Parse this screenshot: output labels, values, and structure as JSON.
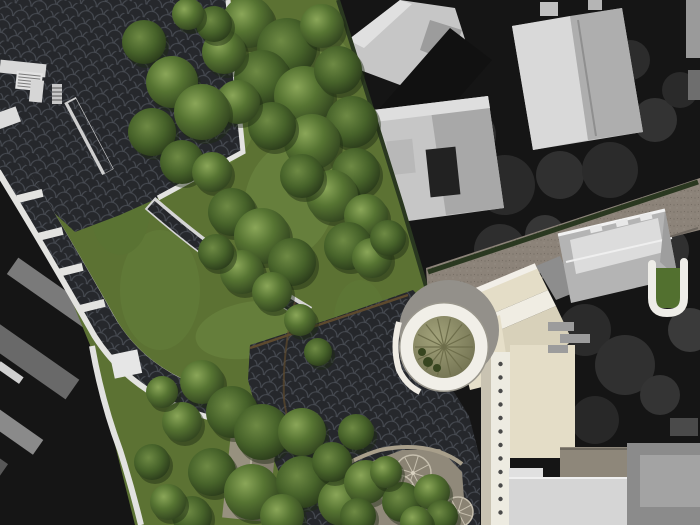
{
  "image": {
    "kind": "architectural-site-plan-render-over-aerial-photo",
    "width": 700,
    "height": 525
  },
  "palette": {
    "photo_dark": "#151515",
    "photo_shadow": "#0f0f0f",
    "photo_building_light": "#c6c6c6",
    "photo_building_mid": "#a8a8a8",
    "photo_blob": "#2e2e2e",
    "park_lawn": "#5c7233",
    "lawn_light": "#6e8840",
    "tree_highlight": "#8aa658",
    "tree_mid": "#567432",
    "tree_dark": "#2c3d1c",
    "tree_shadow": "#1d2a12",
    "plaza_paving": "#24262a",
    "paving_joint": "#4b4f56",
    "path_white": "#e3e3e0",
    "road_taupe": "#8c8379",
    "road_grain": "#7c746b",
    "curb_dark": "#6e675f",
    "hedge_dark": "#2a3820",
    "soil_brown": "#6b5536",
    "building_cream": "#e4ddc7",
    "building_cream_dark": "#d8d1ba",
    "trim_white": "#f2efe8",
    "rotunda_ring": "#f1efe8",
    "rotunda_cone_light": "#a3a37b",
    "rotunda_cone_dark": "#6e6e4e",
    "cone_spoke": "#6e6e4b",
    "apron_gray": "#93908a",
    "roof_gray": "#b4b4b4",
    "roof_gray_light": "#dcdcdc",
    "ground_tan": "#90897a",
    "slab_light": "#d5d5d5",
    "slab_gray": "#8b8b8b",
    "column_dot": "#4a4a4a",
    "carousel_fill": "#8a8373",
    "carousel_line": "#c6bfae",
    "pavilion_roof_left": "#97917f",
    "pavilion_roof_right": "#857f6f",
    "pavilion_ridge": "#b3ad9c"
  },
  "features": {
    "aerial_photo": "black-and-white aerial photograph context",
    "park": "rendered park lawn with tree canopy",
    "plaza": "dark fan-scale paved plaza",
    "paths": "park footpaths with white edge and bench strips",
    "road": "taupe access road",
    "rotunda": "circular rotunda with conical amphitheater roof",
    "building": "cream building complex with colonnade",
    "hip_roof_building": "gray hip-roof building",
    "pavilion": "garden pavilion",
    "playground": "radial carousel platforms"
  }
}
